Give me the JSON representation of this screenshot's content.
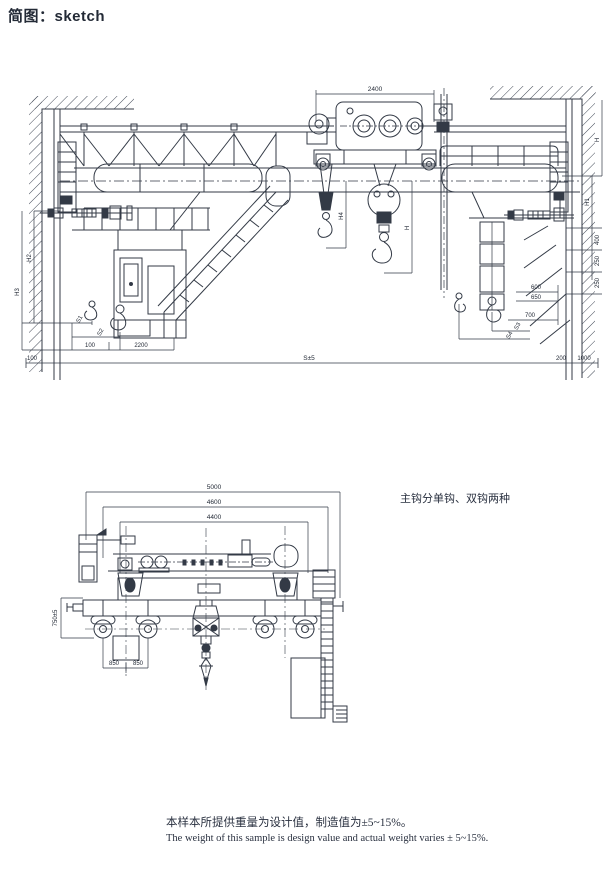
{
  "header": {
    "title": "简图：sketch"
  },
  "note_right": "主钩分单钩、双钩两种",
  "footer": {
    "zh": "本样本所提供重量为设计值，制造值为±5~15%。",
    "en": "The weight of this sample is design value and actual weight varies ± 5~15%."
  },
  "front_view": {
    "dims": {
      "trolley": "2400",
      "span": "S±5",
      "h": "H",
      "h1": "H1",
      "h2": "H2",
      "h3": "H3",
      "h4": "H4",
      "s1": "S1",
      "s2": "S2",
      "s3": "S3",
      "s4": "S4",
      "n100": "100",
      "n2200": "2200",
      "n400": "400",
      "n250a": "250",
      "n250b": "250",
      "n600": "600",
      "n650": "650",
      "n700": "700",
      "n200": "200",
      "n1000": "1000",
      "corner": "100"
    }
  },
  "end_view": {
    "dims": {
      "n5000": "5000",
      "n4600": "4600",
      "n4400": "4400",
      "n850a": "850",
      "n850b": "850",
      "rail": "750±5"
    }
  },
  "colors": {
    "ink": "#2a3140",
    "paper": "#ffffff"
  }
}
